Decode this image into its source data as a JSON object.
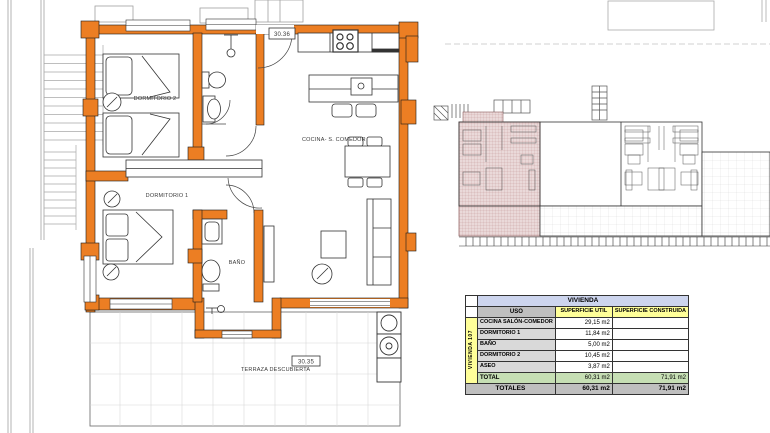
{
  "plan": {
    "room_labels": {
      "dormitorio2": "DORMITORIO 2",
      "dormitorio1": "DORMITORIO 1",
      "bano": "BAÑO",
      "cocina": "COCINA- S. COMEDOR",
      "terraza": "TERRAZA DESCUBIERTA"
    },
    "tags": {
      "entry": "30.36",
      "terraza": "30.35"
    }
  },
  "table": {
    "title": "VIVIENDA",
    "row_group_label": "VIVIENDA 107",
    "columns": {
      "uso": "USO",
      "util": "SUPERFICIE UTIL",
      "construida": "SUPERFICIE CONSTRUIDA"
    },
    "rows": [
      {
        "uso": "COCINA SALÓN-COMEDOR",
        "util": "29,15 m2",
        "construida": ""
      },
      {
        "uso": "DORMITORIO 1",
        "util": "11,84 m2",
        "construida": ""
      },
      {
        "uso": "BAÑO",
        "util": "5,00 m2",
        "construida": ""
      },
      {
        "uso": "DORMITORIO 2",
        "util": "10,45 m2",
        "construida": ""
      },
      {
        "uso": "ASEO",
        "util": "3,87 m2",
        "construida": ""
      }
    ],
    "total": {
      "label": "TOTAL",
      "util": "60,31 m2",
      "construida": "71,91 m2"
    },
    "totales": {
      "label": "TOTALES",
      "util": "60,31 m2",
      "construida": "71,91 m2"
    }
  },
  "colors": {
    "wall_orange": "#EC7E23",
    "highlight_pink": "#EAD9D9",
    "table_title_bg": "#CDD5EE",
    "table_header_gray": "#BFBFBF",
    "table_yellow": "#FFFF99",
    "table_green": "#C6DFB4",
    "table_row_gray": "#D9D9D9"
  }
}
